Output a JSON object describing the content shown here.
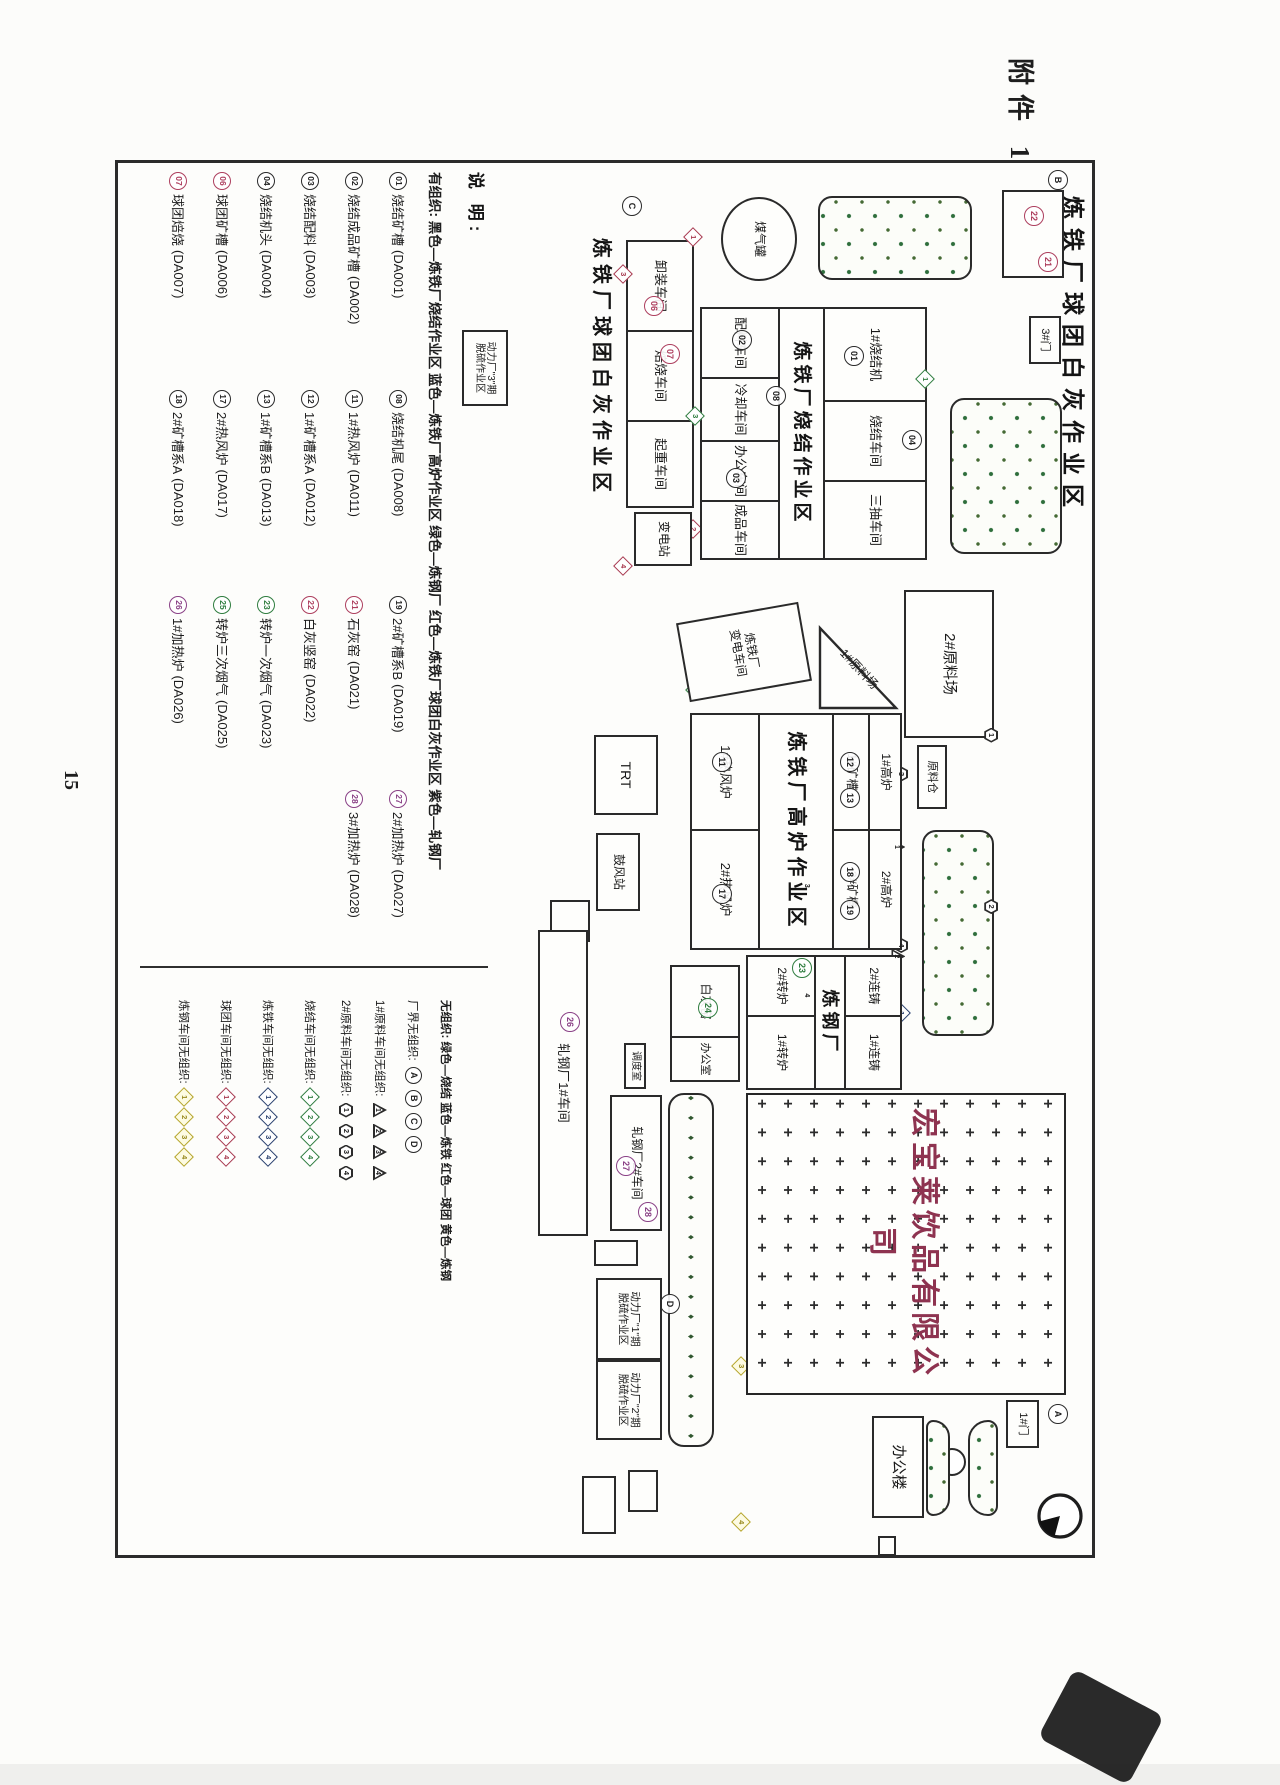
{
  "page": {
    "attachment": "附件 1",
    "page_no": "15"
  },
  "map": {
    "title_top": "炼铁厂球团白灰作业区",
    "title_mid": "炼铁厂球团白灰作业区",
    "labels": {
      "gate3": "3#门",
      "gas_tank": "煤气罐",
      "unload": "卸装车间",
      "roast": "焙烧车间",
      "crane": "起重车间",
      "substation": "变电站",
      "sinter_area": "炼铁厂烧结作业区",
      "sinter_machine": "1#烧结机",
      "sinter_shop": "烧结车间",
      "main_draft": "三抽车间",
      "batching": "配料车间",
      "cooling": "冷却车间",
      "office_shop": "办公车间",
      "product": "成品车间",
      "yard1": "1#原料场",
      "yard2": "2#原料场",
      "bin": "原料仓",
      "power_sub_l1": "炼铁厂",
      "power_sub_l2": "变电车间",
      "blast_area": "炼铁厂高炉作业区",
      "bf1": "1#高炉",
      "bf2": "2#高炉",
      "orebin1": "1#矿槽",
      "orebin2": "2#矿槽",
      "stove1": "1#热风炉",
      "stove2": "2#热风炉",
      "trt": "TRT",
      "blower": "鼓风站",
      "steel": "炼钢厂",
      "cast2": "2#连铸",
      "cast1": "1#连铸",
      "conv2": "2#转炉",
      "conv1": "1#转炉",
      "lime": "白灰窑",
      "lime_office": "办公室",
      "roll1": "轧钢厂1#车间",
      "roll2": "轧钢厂2#车间",
      "dispatch": "调度室",
      "power1_l1": "动力厂\"1\"期",
      "power1_l2": "脱硫作业区",
      "power2_l1": "动力厂\"2\"期",
      "power2_l2": "脱硫作业区",
      "power3_l1": "动力厂\"3\"期",
      "power3_l2": "脱硫作业区",
      "company": "宏宝莱饮品有限公司",
      "office": "办公楼",
      "gate1": "1#门"
    },
    "nums": {
      "n01": "01",
      "n02": "02",
      "n03": "03",
      "n04": "04",
      "n06": "06",
      "n07": "07",
      "n08": "08",
      "n11": "11",
      "n12": "12",
      "n13": "13",
      "n17": "17",
      "n18": "18",
      "n19": "19",
      "n21": "21",
      "n22": "22",
      "n23": "23",
      "n24": "24",
      "n26": "26",
      "n27": "27",
      "n28": "28",
      "A": "A",
      "B": "B",
      "C": "C",
      "D": "D"
    },
    "dnums": [
      "1",
      "2",
      "3",
      "4"
    ]
  },
  "legend_organized": {
    "title": "说 明:",
    "header": "有组织:  黑色—炼铁厂烧结作业区   蓝色—炼铁厂高炉作业区   绿色—炼钢厂   红色—炼铁厂球团白灰作业区   紫色—轧钢厂",
    "col1": [
      {
        "n": "01",
        "l": "烧结矿槽",
        "c": "(DA001)"
      },
      {
        "n": "02",
        "l": "烧结成品矿槽",
        "c": "(DA002)"
      },
      {
        "n": "03",
        "l": "烧结配料",
        "c": "(DA003)"
      },
      {
        "n": "04",
        "l": "烧结机头",
        "c": "(DA004)"
      },
      {
        "n": "06",
        "l": "球团矿槽",
        "c": "(DA006)"
      },
      {
        "n": "07",
        "l": "球团焙烧",
        "c": "(DA007)"
      }
    ],
    "col2": [
      {
        "n": "08",
        "l": "烧结机尾",
        "c": "(DA008)"
      },
      {
        "n": "11",
        "l": "1#热风炉",
        "c": "(DA011)"
      },
      {
        "n": "12",
        "l": "1#矿槽系A",
        "c": "(DA012)"
      },
      {
        "n": "13",
        "l": "1#矿槽系B",
        "c": "(DA013)"
      },
      {
        "n": "17",
        "l": "2#热风炉",
        "c": "(DA017)"
      },
      {
        "n": "18",
        "l": "2#矿槽系A",
        "c": "(DA018)"
      }
    ],
    "col3": [
      {
        "n": "19",
        "l": "2#矿槽系B",
        "c": "(DA019)"
      },
      {
        "n": "21",
        "l": "石灰窑",
        "c": "(DA021)"
      },
      {
        "n": "22",
        "l": "白灰竖窑",
        "c": "(DA022)"
      },
      {
        "n": "23",
        "l": "转炉一次烟气",
        "c": "(DA023)"
      },
      {
        "n": "25",
        "l": "转炉三次烟气",
        "c": "(DA025)"
      },
      {
        "n": "26",
        "l": "1#加热炉",
        "c": "(DA026)"
      }
    ],
    "col4": [
      {
        "n": "27",
        "l": "2#加热炉",
        "c": "(DA027)"
      },
      {
        "n": "28",
        "l": "3#加热炉",
        "c": "(DA028)"
      }
    ]
  },
  "legend_fugitive": {
    "header": "无组织:  绿色—烧结   蓝色—炼铁   红色—球团   黄色—炼钢",
    "rows": [
      {
        "label": "厂界无组织:",
        "items": [
          "A",
          "B",
          "C",
          "D"
        ]
      },
      {
        "label": "1#原料车间无组织:",
        "items": [
          "1",
          "2",
          "3",
          "4"
        ]
      },
      {
        "label": "2#原料车间无组织:",
        "items": [
          "1",
          "2",
          "3",
          "4"
        ]
      },
      {
        "label": "烧结车间无组织:",
        "items": [
          "1",
          "2",
          "3",
          "4"
        ]
      },
      {
        "label": "炼铁车间无组织:",
        "items": [
          "1",
          "2",
          "3",
          "4"
        ]
      },
      {
        "label": "球团车间无组织:",
        "items": [
          "1",
          "2",
          "3",
          "4"
        ]
      },
      {
        "label": "炼钢车间无组织:",
        "items": [
          "1",
          "2",
          "3",
          "4"
        ]
      }
    ]
  },
  "colors": {
    "ink": "#2a2a2a",
    "red": "#ad3f5e",
    "green": "#2f7d3f",
    "purple": "#8a4186",
    "yellow": "#b5a52c",
    "blue": "#29406e",
    "tree": "#2e6e3c",
    "company_text": "#8e3350"
  }
}
